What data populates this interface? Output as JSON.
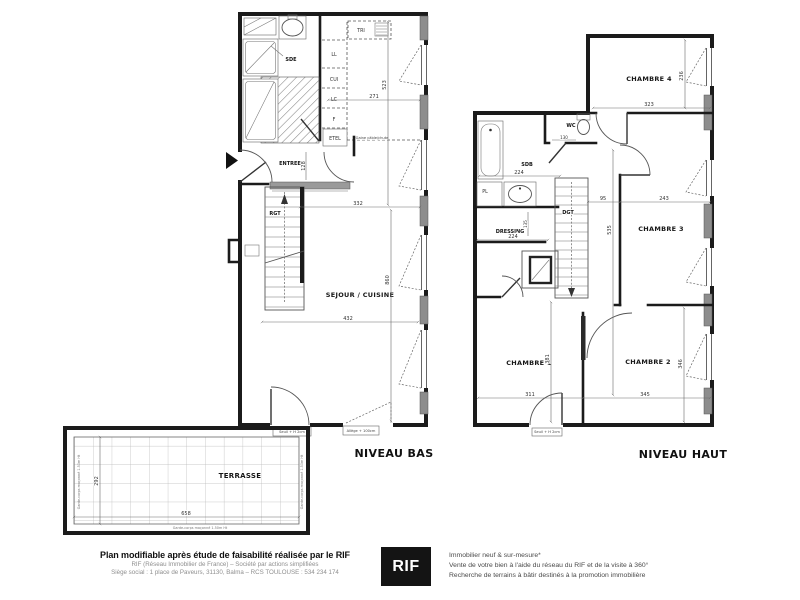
{
  "plans": {
    "bas": {
      "title": "NIVEAU BAS",
      "rooms": {
        "sde": "SDE",
        "entree": "ENTREE",
        "rgt": "RGT",
        "sejour": "SEJOUR / CUISINE",
        "terrasse": "TERRASSE"
      },
      "units": {
        "tri": "TRI",
        "ll": "LL",
        "cui": "CUI",
        "lc": "LC",
        "f": "F",
        "etel": "ETEL"
      },
      "dims": {
        "d271": "271",
        "d523": "523",
        "d332": "332",
        "d860": "860",
        "d432": "432",
        "d128": "128",
        "d658": "658",
        "d292": "292"
      },
      "notes": {
        "gaine": "Gaine câble/chute",
        "seuil": "Seuil + H 2cm",
        "allege": "Allège + 100cm",
        "garde": "Garde-corps maçonné 1.50m Ht"
      }
    },
    "haut": {
      "title": "NIVEAU HAUT",
      "rooms": {
        "ch4": "CHAMBRE 4",
        "wc": "WC",
        "sdb": "SDB",
        "pl": "PL",
        "dressing": "DRESSING",
        "dgt": "DGT",
        "ch3": "CHAMBRE 3",
        "ch2": "CHAMBRE 2",
        "ch1": "CHAMBRE 1"
      },
      "dims": {
        "d323": "323",
        "d236": "236",
        "d224a": "224",
        "d130": "130",
        "d224b": "224",
        "d135": "135",
        "d95": "95",
        "d243": "243",
        "d535": "535",
        "d311": "311",
        "d381": "381",
        "d345": "345",
        "d346": "346"
      },
      "notes": {
        "seuil": "Seuil + H 2cm"
      }
    }
  },
  "footer": {
    "left": {
      "title": "Plan modifiable après étude de faisabilité réalisée par le RIF",
      "line2": "RIF (Réseau Immobilier de France) – Société par actions simplifiées",
      "line3": "Siège social : 1 place de Paveurs, 31130, Balma – RCS TOULOUSE : 534 234 174"
    },
    "logo": {
      "text": "RIF"
    },
    "right": {
      "line1": "Immobilier neuf & sur-mesure*",
      "line2": "Vente de votre bien à l'aide du réseau du RIF et de la visite à 360°",
      "line3": "Recherche de terrains à bâtir destinés à la promotion immobilière"
    }
  },
  "colors": {
    "ink": "#1b1b1b",
    "muted_text": "#8f8f8f",
    "logo_bg": "#141414",
    "logo_text": "#ffffff"
  }
}
